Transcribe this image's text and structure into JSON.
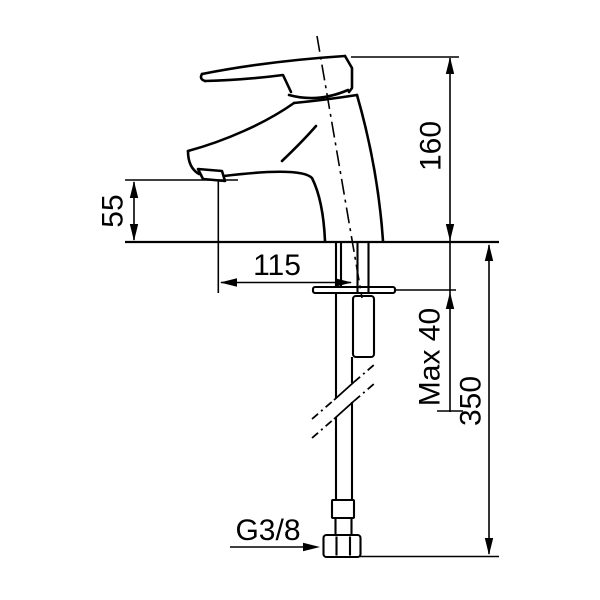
{
  "drawing": {
    "background": "#ffffff",
    "line_color": "#000000",
    "dimensions": {
      "total_height": {
        "label": "160"
      },
      "spout_height": {
        "label": "55"
      },
      "spout_reach": {
        "label": "115"
      },
      "max_deck_thickness": {
        "label": "Max 40"
      },
      "hose_length": {
        "label": "350"
      },
      "thread_size": {
        "label": "G3/8"
      }
    }
  }
}
